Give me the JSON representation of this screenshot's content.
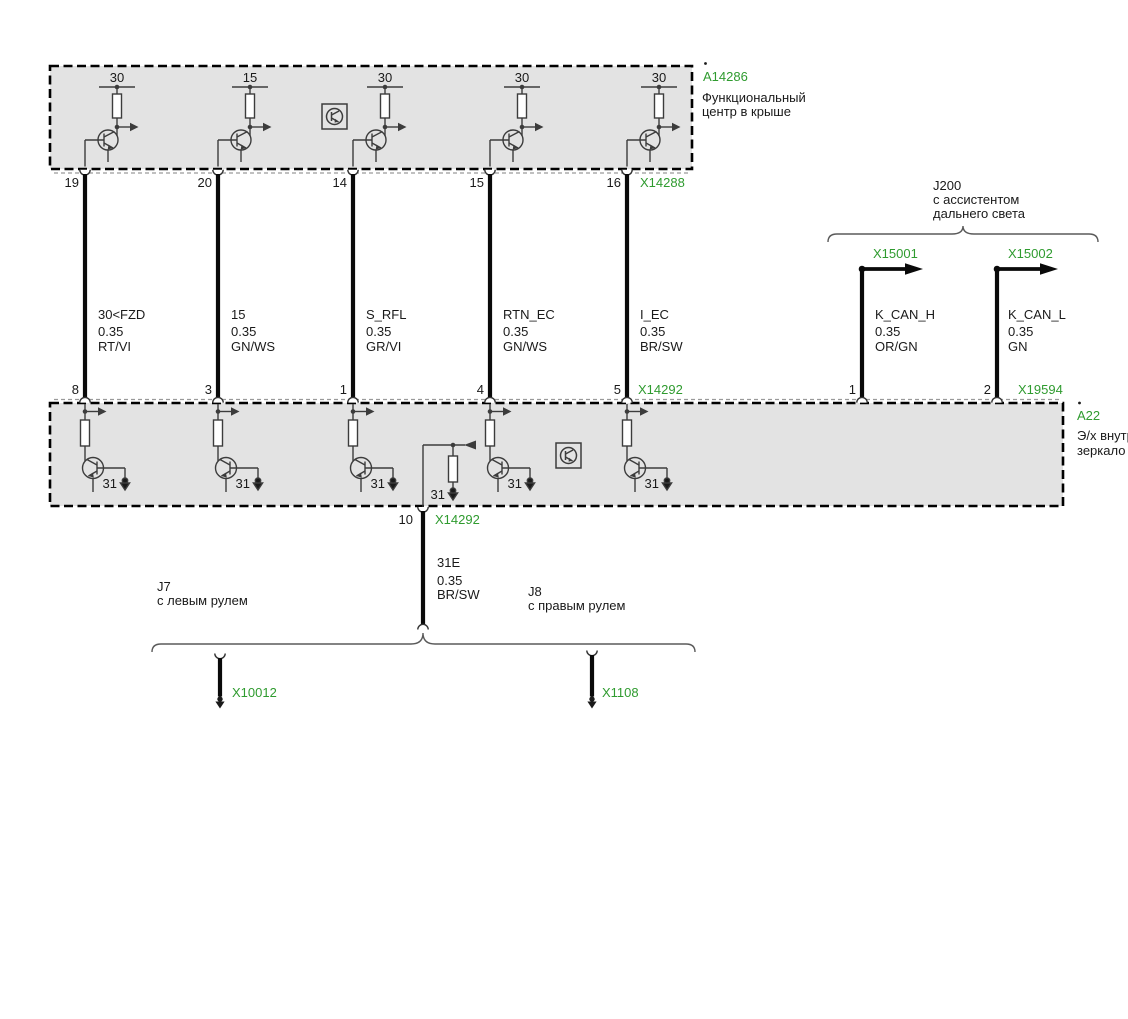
{
  "colors": {
    "connector_green": "#2f9b2f",
    "module_fill": "#e3e3e3",
    "wire_black": "#0a0a0a"
  },
  "roof": {
    "id": "A14286",
    "title1": "Функциональный",
    "title2": "центр в крыше",
    "connector": "X14288",
    "branches": [
      {
        "supply": "30",
        "pin": "19"
      },
      {
        "supply": "15",
        "pin": "20"
      },
      {
        "supply": "30",
        "pin": "14"
      },
      {
        "supply": "30",
        "pin": "15"
      },
      {
        "supply": "30",
        "pin": "16"
      }
    ]
  },
  "harness": [
    {
      "signal": "30<FZD",
      "size": "0.35",
      "color": "RT/VI",
      "pin": "8"
    },
    {
      "signal": "15",
      "size": "0.35",
      "color": "GN/WS",
      "pin": "3"
    },
    {
      "signal": "S_RFL",
      "size": "0.35",
      "color": "GR/VI",
      "pin": "1"
    },
    {
      "signal": "RTN_EC",
      "size": "0.35",
      "color": "GN/WS",
      "pin": "4"
    },
    {
      "signal": "I_EC",
      "size": "0.35",
      "color": "BR/SW",
      "pin": "5"
    }
  ],
  "mirror": {
    "id": "A22",
    "title1": "Э/х внутр",
    "title2": "зеркало",
    "connector_main": "X14292",
    "connector_can": "X19594",
    "ground": "31",
    "ground_pin": "10"
  },
  "j200": {
    "id": "J200",
    "desc1": "с ассистентом",
    "desc2": "дальнего света",
    "left": {
      "connector": "X15001",
      "signal": "K_CAN_H",
      "size": "0.35",
      "color": "OR/GN",
      "pin": "1"
    },
    "right": {
      "connector": "X15002",
      "signal": "K_CAN_L",
      "size": "0.35",
      "color": "GN",
      "pin": "2"
    }
  },
  "ground_wire": {
    "signal": "31E",
    "size": "0.35",
    "color": "BR/SW"
  },
  "variants": {
    "left": {
      "id": "J7",
      "desc": "с левым рулем",
      "connector": "X10012"
    },
    "right": {
      "id": "J8",
      "desc": "с правым рулем",
      "connector": "X1108"
    }
  }
}
